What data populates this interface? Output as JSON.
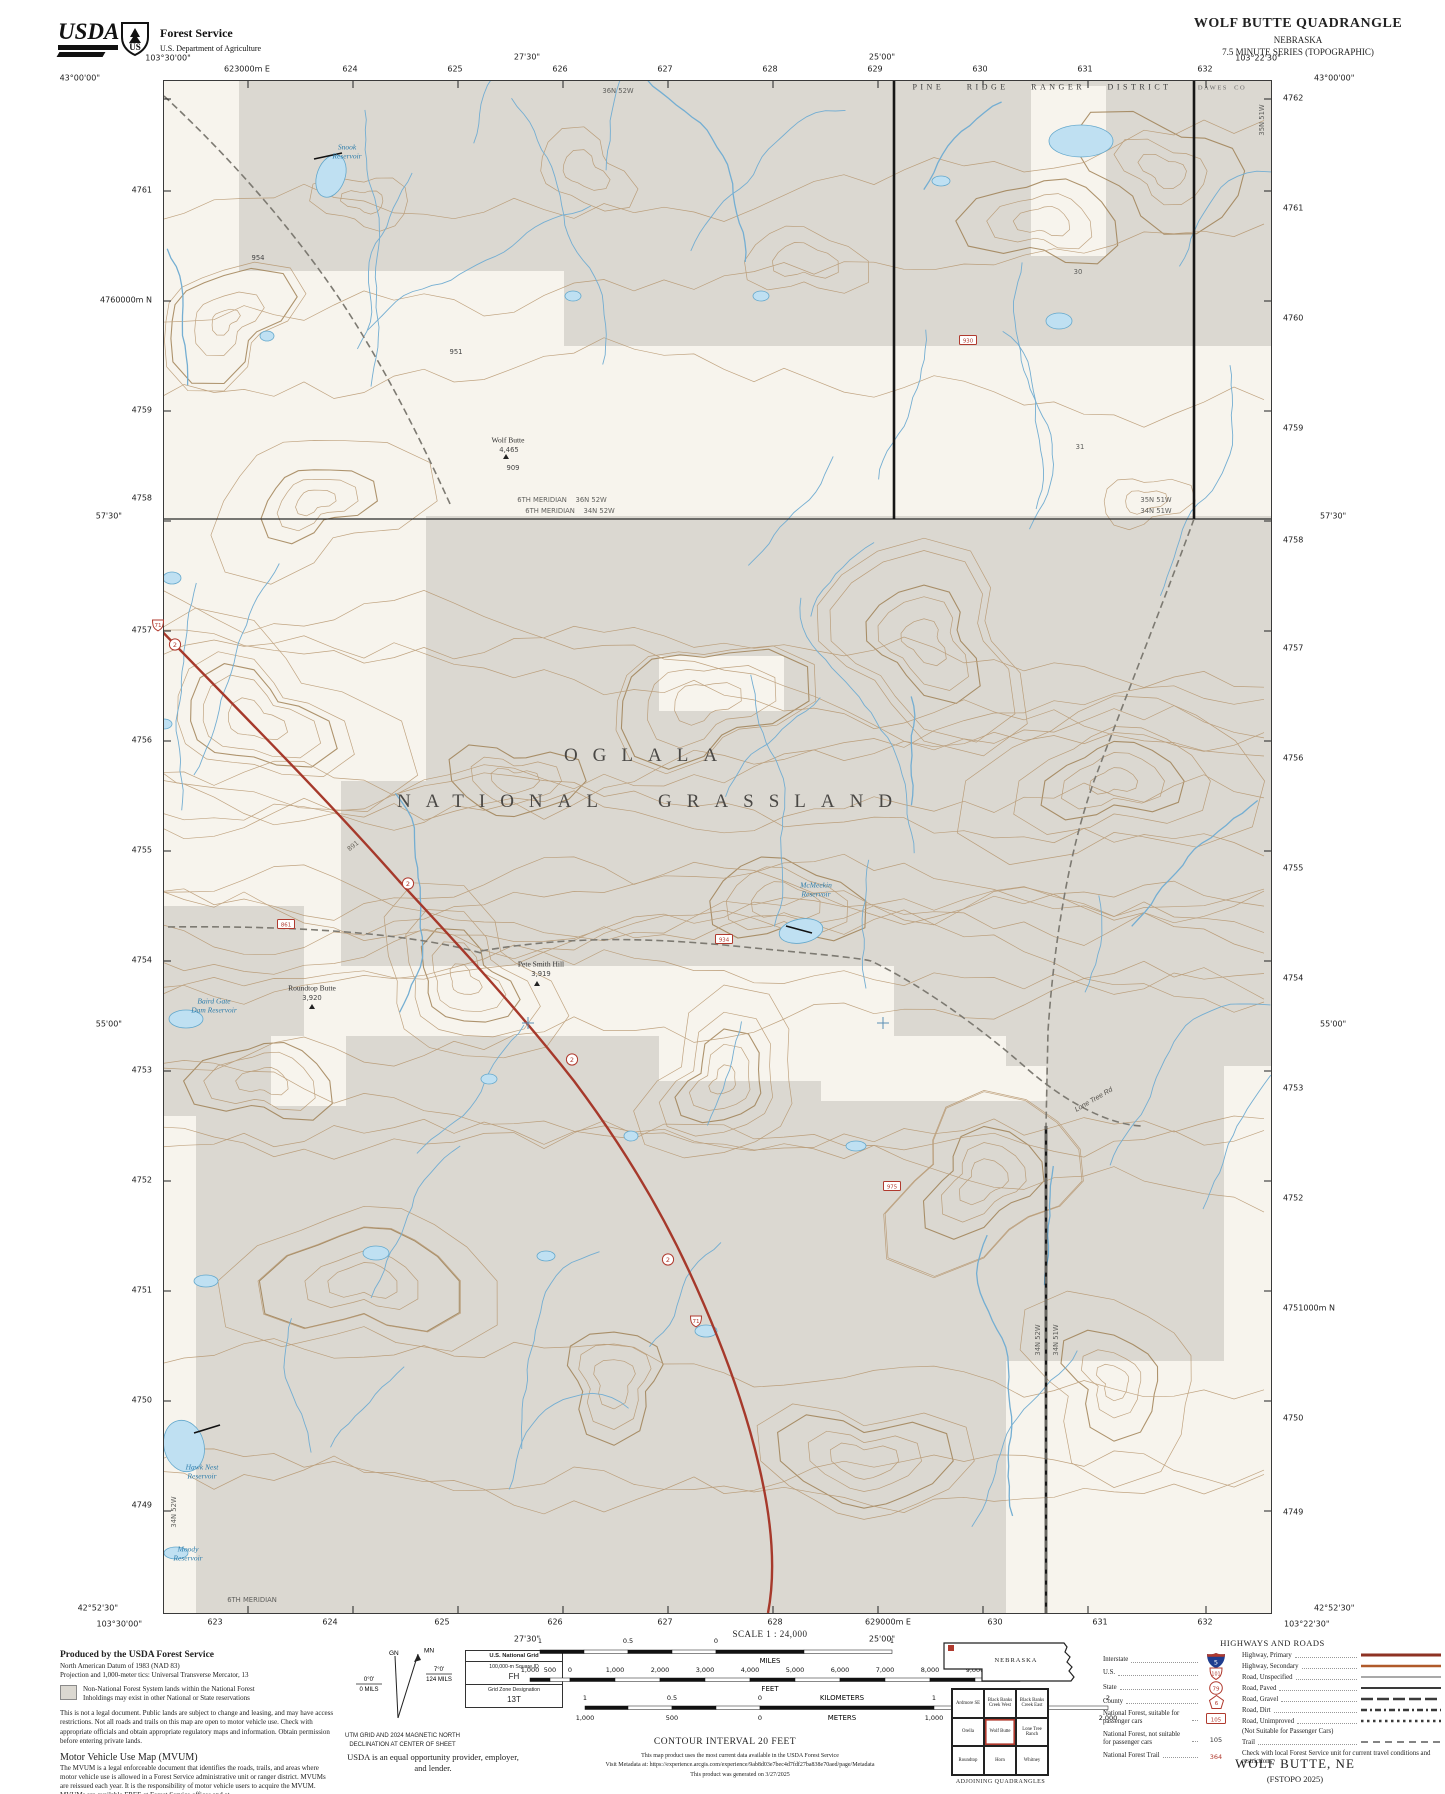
{
  "colors": {
    "cream": "#f7f4ed",
    "nfs_gray": "#dbd8d1",
    "contour": "#b39066",
    "contour_index": "#9c7c4e",
    "water_line": "#74aed2",
    "lake_fill": "#bfe0f2",
    "lake_edge": "#64a8cc",
    "highway_red": "#a6392b",
    "marker_red": "#b03a2e",
    "road_gray": "#7d7a72",
    "interstate_blue": "#1f3d8f"
  },
  "header": {
    "logo_text": "USDA",
    "agency": "Forest Service",
    "dept": "U.S. Department of Agriculture",
    "title": "WOLF BUTTE QUADRANGLE",
    "state": "NEBRASKA",
    "series": "7.5 MINUTE SERIES (TOPOGRAPHIC)"
  },
  "map_edges": {
    "top": [
      {
        "t": "43°00'00\"",
        "x": 100,
        "y": 78,
        "a": "e"
      },
      {
        "t": "103°30'00\"",
        "x": 168,
        "y": 58
      },
      {
        "t": "623000m E",
        "x": 247,
        "y": 69
      },
      {
        "t": "624",
        "x": 350,
        "y": 69
      },
      {
        "t": "625",
        "x": 455,
        "y": 69
      },
      {
        "t": "27'30\"",
        "x": 527,
        "y": 57
      },
      {
        "t": "626",
        "x": 560,
        "y": 69
      },
      {
        "t": "627",
        "x": 665,
        "y": 69
      },
      {
        "t": "628",
        "x": 770,
        "y": 69
      },
      {
        "t": "25'00\"",
        "x": 882,
        "y": 57
      },
      {
        "t": "629",
        "x": 875,
        "y": 69
      },
      {
        "t": "630",
        "x": 980,
        "y": 69
      },
      {
        "t": "631",
        "x": 1085,
        "y": 69
      },
      {
        "t": "632",
        "x": 1205,
        "y": 69
      },
      {
        "t": "103°22'30\"",
        "x": 1258,
        "y": 58
      },
      {
        "t": "43°00'00\"",
        "x": 1314,
        "y": 78,
        "a": "w"
      }
    ],
    "bottom": [
      {
        "t": "42°52'30\"",
        "x": 118,
        "y": 1608,
        "a": "e"
      },
      {
        "t": "103°30'00\"",
        "x": 142,
        "y": 1624,
        "a": "e"
      },
      {
        "t": "623",
        "x": 215,
        "y": 1622
      },
      {
        "t": "624",
        "x": 330,
        "y": 1622
      },
      {
        "t": "625",
        "x": 442,
        "y": 1622
      },
      {
        "t": "626",
        "x": 555,
        "y": 1622
      },
      {
        "t": "27'30\"",
        "x": 527,
        "y": 1639
      },
      {
        "t": "627",
        "x": 665,
        "y": 1622
      },
      {
        "t": "628",
        "x": 775,
        "y": 1622
      },
      {
        "t": "629000m E",
        "x": 888,
        "y": 1622
      },
      {
        "t": "25'00\"",
        "x": 882,
        "y": 1639
      },
      {
        "t": "630",
        "x": 995,
        "y": 1622
      },
      {
        "t": "631",
        "x": 1100,
        "y": 1622
      },
      {
        "t": "632",
        "x": 1205,
        "y": 1622
      },
      {
        "t": "42°52'30\"",
        "x": 1314,
        "y": 1608,
        "a": "w"
      },
      {
        "t": "103°22'30\"",
        "x": 1284,
        "y": 1624,
        "a": "w"
      }
    ],
    "left": [
      {
        "t": "4761",
        "x": 152,
        "y": 190,
        "a": "e"
      },
      {
        "t": "4760000m N",
        "x": 152,
        "y": 300,
        "a": "e"
      },
      {
        "t": "4759",
        "x": 152,
        "y": 410,
        "a": "e"
      },
      {
        "t": "4758",
        "x": 152,
        "y": 498,
        "a": "e"
      },
      {
        "t": "57'30\"",
        "x": 122,
        "y": 516,
        "a": "e"
      },
      {
        "t": "4757",
        "x": 152,
        "y": 630,
        "a": "e"
      },
      {
        "t": "4756",
        "x": 152,
        "y": 740,
        "a": "e"
      },
      {
        "t": "4755",
        "x": 152,
        "y": 850,
        "a": "e"
      },
      {
        "t": "4754",
        "x": 152,
        "y": 960,
        "a": "e"
      },
      {
        "t": "55'00\"",
        "x": 122,
        "y": 1024,
        "a": "e"
      },
      {
        "t": "4753",
        "x": 152,
        "y": 1070,
        "a": "e"
      },
      {
        "t": "4752",
        "x": 152,
        "y": 1180,
        "a": "e"
      },
      {
        "t": "4751",
        "x": 152,
        "y": 1290,
        "a": "e"
      },
      {
        "t": "4750",
        "x": 152,
        "y": 1400,
        "a": "e"
      },
      {
        "t": "4749",
        "x": 152,
        "y": 1505,
        "a": "e"
      }
    ],
    "right": [
      {
        "t": "4762",
        "x": 1283,
        "y": 98,
        "a": "w"
      },
      {
        "t": "4761",
        "x": 1283,
        "y": 208,
        "a": "w"
      },
      {
        "t": "4760",
        "x": 1283,
        "y": 318,
        "a": "w"
      },
      {
        "t": "4759",
        "x": 1283,
        "y": 428,
        "a": "w"
      },
      {
        "t": "57'30\"",
        "x": 1320,
        "y": 516,
        "a": "w"
      },
      {
        "t": "4758",
        "x": 1283,
        "y": 540,
        "a": "w"
      },
      {
        "t": "4757",
        "x": 1283,
        "y": 648,
        "a": "w"
      },
      {
        "t": "4756",
        "x": 1283,
        "y": 758,
        "a": "w"
      },
      {
        "t": "4755",
        "x": 1283,
        "y": 868,
        "a": "w"
      },
      {
        "t": "4754",
        "x": 1283,
        "y": 978,
        "a": "w"
      },
      {
        "t": "55'00\"",
        "x": 1320,
        "y": 1024,
        "a": "w"
      },
      {
        "t": "4753",
        "x": 1283,
        "y": 1088,
        "a": "w"
      },
      {
        "t": "4752",
        "x": 1283,
        "y": 1198,
        "a": "w"
      },
      {
        "t": "4751000m N",
        "x": 1283,
        "y": 1308,
        "a": "w"
      },
      {
        "t": "4750",
        "x": 1283,
        "y": 1418,
        "a": "w"
      },
      {
        "t": "4749",
        "x": 1283,
        "y": 1512,
        "a": "w"
      }
    ]
  },
  "map_labels": [
    {
      "t": "PINE RIDGE RANGER DISTRICT",
      "x": 1042,
      "y": 87,
      "cls": "district"
    },
    {
      "t": "DAWES  CO",
      "x": 1222,
      "y": 88,
      "cls": "county"
    },
    {
      "t": "36N 52W",
      "x": 618,
      "y": 91,
      "cls": "twp"
    },
    {
      "t": "30",
      "x": 1078,
      "y": 272,
      "cls": "twp"
    },
    {
      "t": "31",
      "x": 1080,
      "y": 447,
      "cls": "twp"
    },
    {
      "t": "6TH MERIDIAN    36N 52W",
      "x": 562,
      "y": 500,
      "cls": "twp"
    },
    {
      "t": "6TH MERIDIAN    34N 52W",
      "x": 570,
      "y": 511,
      "cls": "twp"
    },
    {
      "t": "35N 51W",
      "x": 1156,
      "y": 500,
      "cls": "twp"
    },
    {
      "t": "34N 51W",
      "x": 1156,
      "y": 511,
      "cls": "twp"
    },
    {
      "t": "35N 51W",
      "x": 1262,
      "y": 120,
      "cls": "twp",
      "rot": -90
    },
    {
      "t": "34N 52W",
      "x": 1038,
      "y": 1340,
      "cls": "twp",
      "rot": -90
    },
    {
      "t": "34N 51W",
      "x": 1056,
      "y": 1340,
      "cls": "twp",
      "rot": -90
    },
    {
      "t": "34N 52W",
      "x": 174,
      "y": 1512,
      "cls": "twp",
      "rot": -90
    },
    {
      "t": "6TH MERIDIAN",
      "x": 252,
      "y": 1600,
      "cls": "twp"
    },
    {
      "t": "OGLALA",
      "x": 648,
      "y": 756,
      "cls": "big"
    },
    {
      "t": "NATIONAL GRASSLAND",
      "x": 652,
      "y": 802,
      "cls": "big"
    },
    {
      "t": "Snook\nReservoir",
      "x": 347,
      "y": 152,
      "cls": "water"
    },
    {
      "t": "McMeekin\nReservoir",
      "x": 816,
      "y": 890,
      "cls": "water"
    },
    {
      "t": "Baird Gate\nDam Reservoir",
      "x": 214,
      "y": 1006,
      "cls": "water"
    },
    {
      "t": "Hawk Nest\nReservoir",
      "x": 202,
      "y": 1472,
      "cls": "water"
    },
    {
      "t": "Moody\nReservoir",
      "x": 188,
      "y": 1554,
      "cls": "water"
    },
    {
      "t": "Wolf Butte",
      "x": 508,
      "y": 440,
      "cls": "peak"
    },
    {
      "t": "4,465",
      "x": 509,
      "y": 450,
      "cls": "spot"
    },
    {
      "t": "Pete Smith Hill",
      "x": 541,
      "y": 964,
      "cls": "peak"
    },
    {
      "t": "3,919",
      "x": 541,
      "y": 974,
      "cls": "spot"
    },
    {
      "t": "Roundtop Butte",
      "x": 312,
      "y": 988,
      "cls": "peak"
    },
    {
      "t": "3,920",
      "x": 312,
      "y": 998,
      "cls": "spot"
    },
    {
      "t": "954",
      "x": 258,
      "y": 258,
      "cls": "spot"
    },
    {
      "t": "951",
      "x": 456,
      "y": 352,
      "cls": "spot"
    },
    {
      "t": "909",
      "x": 513,
      "y": 468,
      "cls": "spot"
    },
    {
      "t": "Lone Tree Rd",
      "x": 1094,
      "y": 1100,
      "cls": "roadname",
      "rot": -30
    },
    {
      "t": "891",
      "x": 353,
      "y": 846,
      "cls": "roadnum",
      "rot": -38
    }
  ],
  "map_shields": [
    {
      "k": "us",
      "n": "71",
      "x": 158,
      "y": 628
    },
    {
      "k": "st",
      "n": "2",
      "x": 175,
      "y": 647
    },
    {
      "k": "st",
      "n": "2",
      "x": 408,
      "y": 886
    },
    {
      "k": "st",
      "n": "2",
      "x": 572,
      "y": 1062
    },
    {
      "k": "st",
      "n": "2",
      "x": 668,
      "y": 1262
    },
    {
      "k": "us",
      "n": "71",
      "x": 696,
      "y": 1324
    },
    {
      "k": "fs",
      "n": "861",
      "x": 286,
      "y": 926
    },
    {
      "k": "fs",
      "n": "934",
      "x": 724,
      "y": 941
    },
    {
      "k": "fs",
      "n": "930",
      "x": 968,
      "y": 342
    },
    {
      "k": "fs",
      "n": "975",
      "x": 892,
      "y": 1188
    }
  ],
  "footer": {
    "produced": [
      "Produced by the USDA Forest Service",
      "North American Datum of 1983 (NAD 83)",
      "Projection and 1,000-meter tics: Universal Transverse Mercator, 13"
    ],
    "swatch": [
      "Non-National Forest System lands within the National Forest",
      "Inholdings may exist in other National or State reservations"
    ],
    "legal": "This is not a legal document. Public lands are subject to change and leasing, and may have access restrictions. Not all roads and trails on this map are open to motor vehicle use. Check with appropriate officials and obtain appropriate regulatory maps and information. Obtain permission before entering private lands.",
    "mvum": {
      "heading": "Motor Vehicle Use Map (MVUM)",
      "body": "The MVUM is a legal enforceable document that identifies the roads, trails, and areas where motor vehicle use is allowed in a Forest Service administrative unit or ranger district. MVUMs are reissued each year. It is the responsibility of motor vehicle users to acquire the MVUM. MVUMs are available FREE at Forest Service offices and at",
      "url": "www.fs.usda.gov/recreation/programs/ohv/ohv_maps.shtml"
    },
    "declination": {
      "mn": "MN",
      "gn": "GN",
      "gn_deg": "0°0'",
      "gn_mils": "0 MILS",
      "mn_deg": "7°0'",
      "mn_mils": "124 MILS",
      "caption1": "UTM GRID AND 2024 MAGNETIC NORTH",
      "caption2": "DECLINATION AT CENTER OF SHEET"
    },
    "usng": {
      "title": "U.S. National Grid",
      "sub": "100,000-m Square ID",
      "square": "FH",
      "zone_label": "Grid Zone Designation",
      "zone": "13T"
    },
    "equal_opportunity": "USDA is an equal opportunity provider, employer, and lender.",
    "scale": {
      "heading": "SCALE 1 : 24,000",
      "contour": "CONTOUR INTERVAL 20 FEET",
      "units": {
        "miles": "MILES",
        "feet": "FEET",
        "km": "KILOMETERS",
        "meters": "METERS"
      },
      "miles_labels": [
        "1",
        "0.5",
        "0",
        "1"
      ],
      "feet_labels": [
        "1,000",
        "500",
        "0",
        "1,000",
        "2,000",
        "3,000",
        "4,000",
        "5,000",
        "6,000",
        "7,000",
        "8,000",
        "9,000",
        "10,000"
      ],
      "km_labels": [
        "1",
        "0.5",
        "0",
        "1",
        "2"
      ],
      "meters_labels": [
        "1,000",
        "500",
        "0",
        "1,000",
        "2,000"
      ]
    },
    "metadata": [
      "This map product uses the most current data available in the USDA Forest Service",
      "Visit Metadata at: https://experience.arcgis.com/experience/9ab8d03e7bec4d7fdf27ba838e70aed/page/Metadata",
      "This product was generated on 3/27/2025"
    ],
    "state_inset": {
      "label": "NEBRASKA"
    },
    "quads": {
      "caption": "ADJOINING QUADRANGLES",
      "names": [
        "Ardmore SE",
        "Black Banks Creek West",
        "Black Banks Creek East",
        "Orella",
        "Wolf Butte",
        "Lone Tree Ranch",
        "Roundtop",
        "Horn",
        "Whitney"
      ]
    },
    "legend": {
      "title": "HIGHWAYS AND ROADS",
      "left": [
        {
          "label": "Interstate",
          "icon": "interstate",
          "num": "5"
        },
        {
          "label": "U.S.",
          "icon": "us",
          "num": "101"
        },
        {
          "label": "State",
          "icon": "state",
          "num": "79"
        },
        {
          "label": "County",
          "icon": "county",
          "num": "6"
        },
        {
          "label": "National Forest, suitable for passenger cars",
          "icon": "fsbox",
          "num": "105"
        },
        {
          "label": "National Forest, not suitable for passenger cars",
          "icon": "plain",
          "num": "105"
        },
        {
          "label": "National Forest Trail",
          "icon": "redtext",
          "num": "364"
        }
      ],
      "right": [
        {
          "label": "Highway, Primary",
          "style": "hwy-primary"
        },
        {
          "label": "Highway, Secondary",
          "style": "hwy-secondary"
        },
        {
          "label": "Road, Unspecified",
          "style": "road-unspecified"
        },
        {
          "label": "Road, Paved",
          "style": "road-paved"
        },
        {
          "label": "Road, Gravel",
          "style": "road-gravel"
        },
        {
          "label": "Road, Dirt",
          "style": "road-dirt"
        },
        {
          "label": "Road, Unimproved",
          "style": "road-unimproved"
        },
        {
          "label": "(Not Suitable for Passenger Cars)",
          "style": "none"
        },
        {
          "label": "Trail",
          "style": "trail"
        },
        {
          "label": "Check with local Forest Service unit for current travel conditions and restrictions",
          "style": "note"
        }
      ]
    },
    "sheet": {
      "name": "WOLF BUTTE, NE",
      "edition": "(FSTOPO 2025)"
    }
  }
}
